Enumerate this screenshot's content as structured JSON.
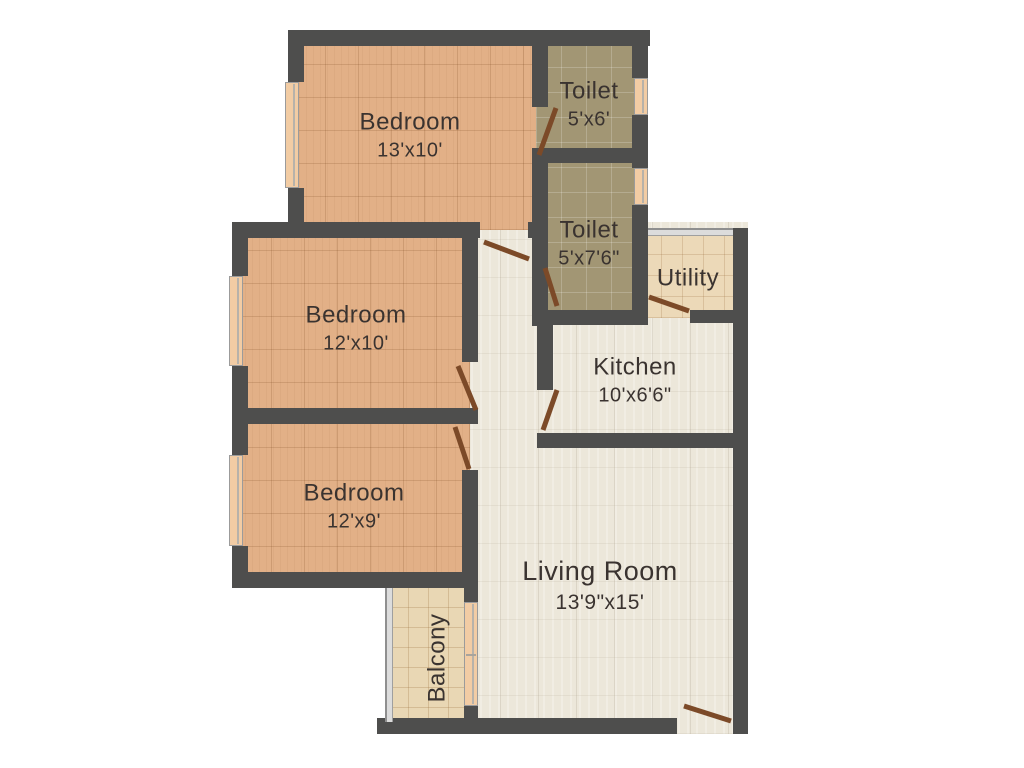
{
  "plan": {
    "rooms": [
      {
        "name": "Bedroom",
        "dims": "13'x10'"
      },
      {
        "name": "Toilet",
        "dims": "5'x6'"
      },
      {
        "name": "Toilet",
        "dims": "5'x7'6\""
      },
      {
        "name": "Utility",
        "dims": ""
      },
      {
        "name": "Kitchen",
        "dims": "10'x6'6\""
      },
      {
        "name": "Bedroom",
        "dims": "12'x10'"
      },
      {
        "name": "Bedroom",
        "dims": "12'x9'"
      },
      {
        "name": "Living Room",
        "dims": "13'9\"x15'"
      },
      {
        "name": "Balcony",
        "dims": ""
      }
    ],
    "colors": {
      "wall": "#4e4e4d",
      "bedroom-floor": "#e2b087",
      "toilet-floor": "#a29674",
      "utility-floor": "#ecd9b8",
      "balcony-floor": "#e9d7b4",
      "living-floor": "#ece7da",
      "window": "#f2cca4",
      "door": "#7c4a28",
      "label-text": "#3a3330"
    }
  }
}
